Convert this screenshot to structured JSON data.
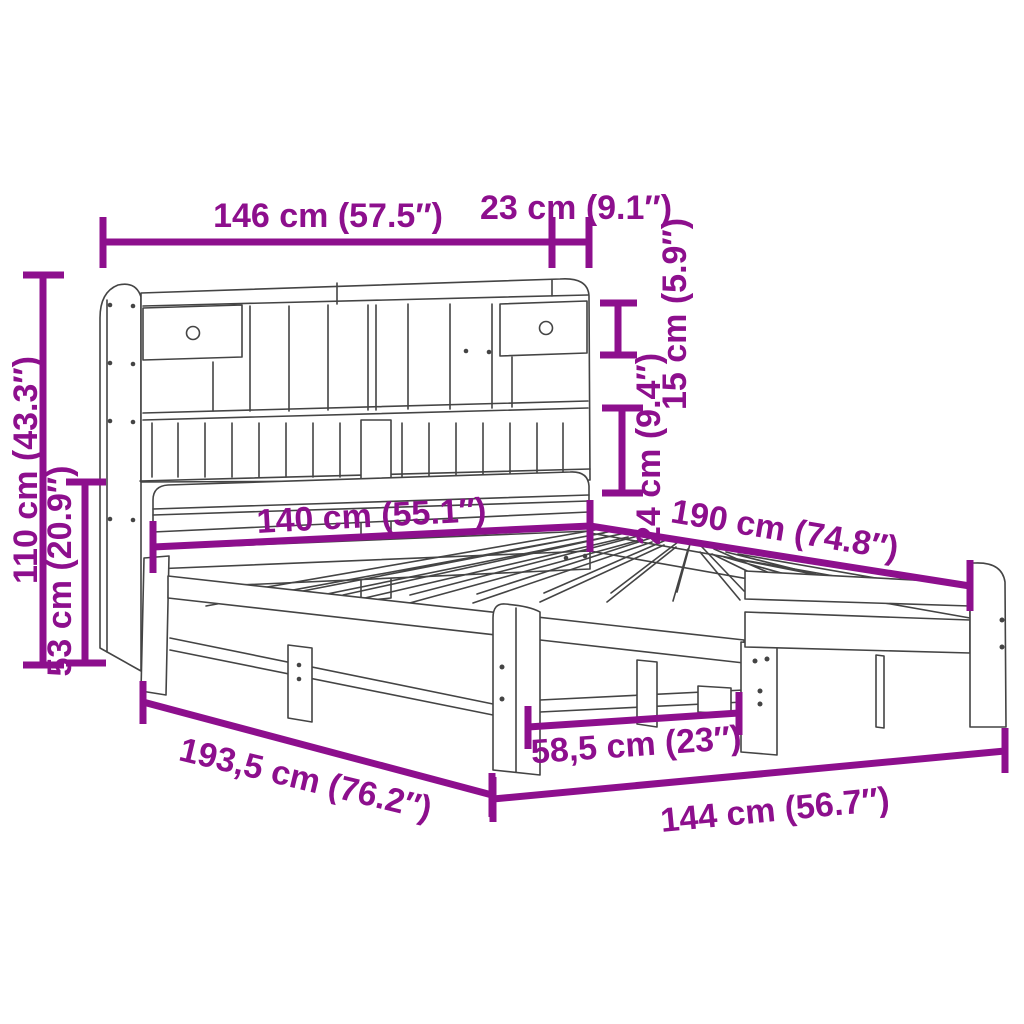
{
  "figure": {
    "kind": "product-dimension-diagram",
    "subject": "bookcase-bed-frame-line-drawing",
    "colors": {
      "accent": "#8D0F8D",
      "line": "#444444",
      "paper": "#FFFFFF"
    }
  },
  "dimensions": [
    {
      "id": "headboard-total-width",
      "label": "146 cm (57.5″)"
    },
    {
      "id": "headboard-depth",
      "label": "23 cm (9.1″)"
    },
    {
      "id": "top-shelf-height",
      "label": "15 cm (5.9″)"
    },
    {
      "id": "mid-shelf-height",
      "label": "24 cm (9.4″)"
    },
    {
      "id": "total-height",
      "label": "110 cm (43.3″)"
    },
    {
      "id": "bed-headboard-height",
      "label": "53 cm (20.9″)"
    },
    {
      "id": "bed-width",
      "label": "140 cm (55.1″)"
    },
    {
      "id": "bed-length",
      "label": "190 cm (74.8″)"
    },
    {
      "id": "frame-total-length",
      "label": "193,5 cm (76.2″)"
    },
    {
      "id": "leg-spacing",
      "label": "58,5 cm (23″)"
    },
    {
      "id": "frame-width",
      "label": "144 cm (56.7″)"
    }
  ]
}
